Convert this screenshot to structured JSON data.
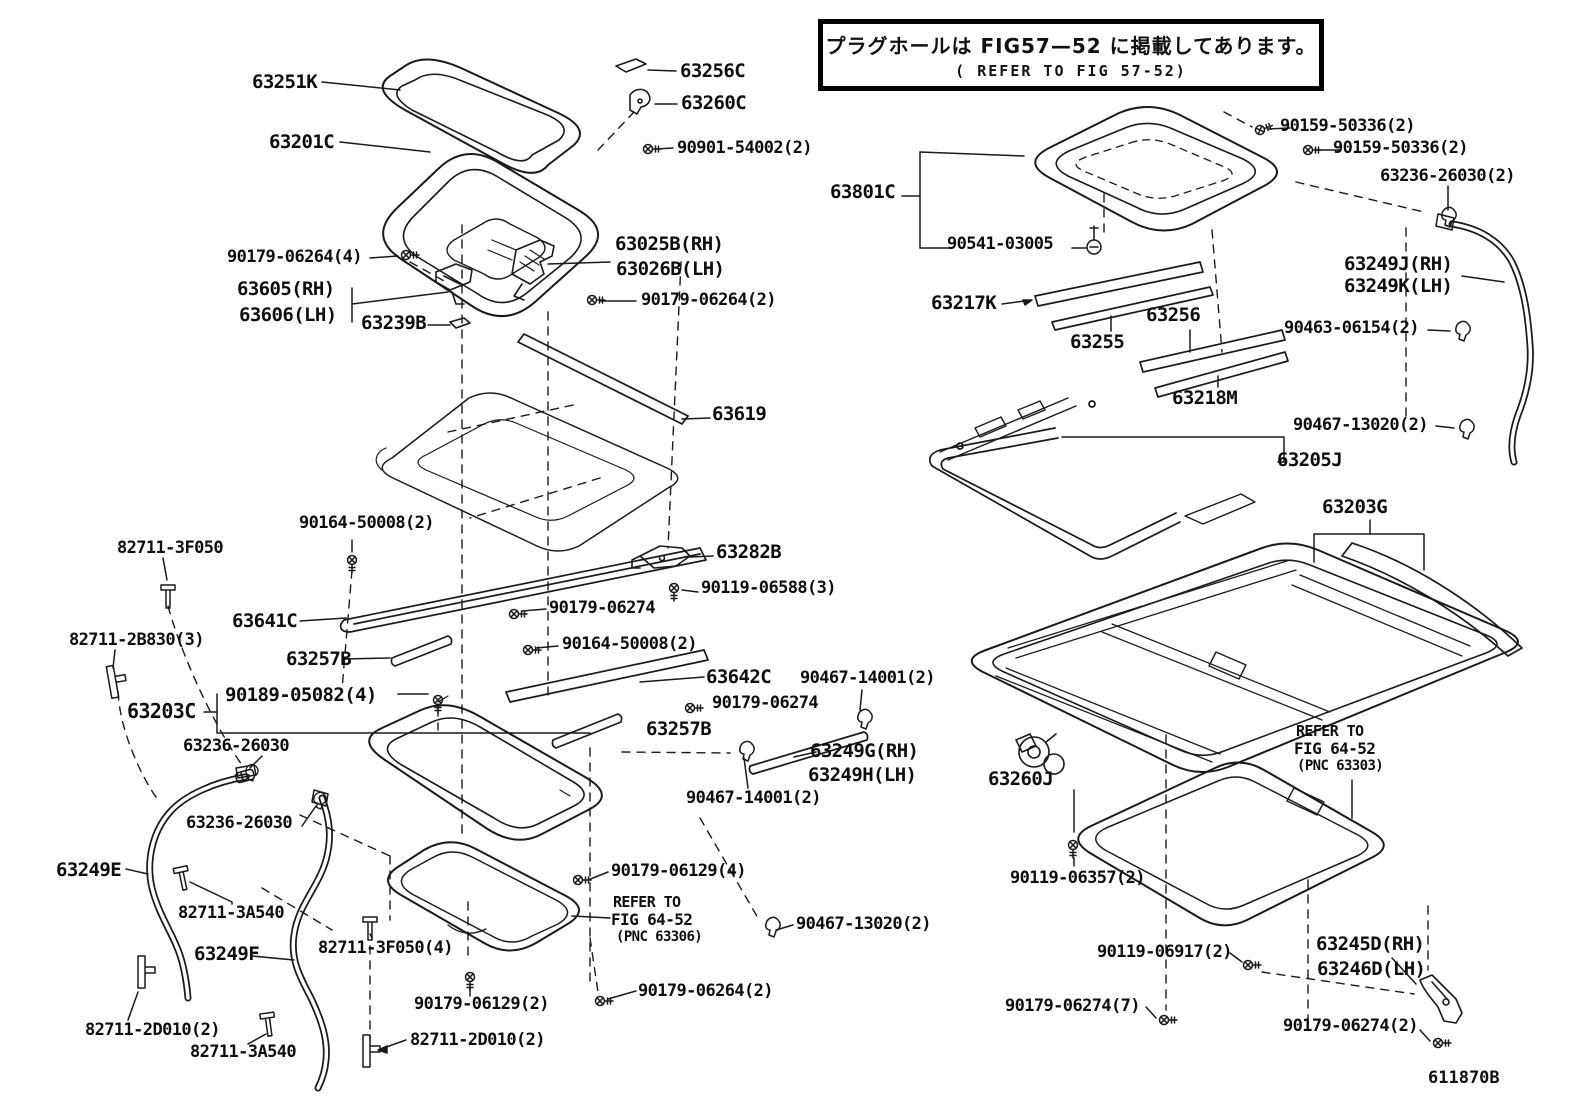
{
  "note_box": {
    "line1": "プラグホールは FIG57—52 に掲載してあります。",
    "line2": "( REFER TO FIG 57-52)"
  },
  "drawing_code": "611870B",
  "labels": [
    {
      "id": "63251k",
      "text": "63251K",
      "x": 252,
      "y": 73,
      "s": 19
    },
    {
      "id": "63201c",
      "text": "63201C",
      "x": 269,
      "y": 133,
      "s": 19
    },
    {
      "id": "63256c",
      "text": "63256C",
      "x": 680,
      "y": 62,
      "s": 19
    },
    {
      "id": "63260c",
      "text": "63260C",
      "x": 681,
      "y": 94,
      "s": 19
    },
    {
      "id": "90901-54002",
      "text": "90901-54002(2)",
      "x": 677,
      "y": 140,
      "s": 17
    },
    {
      "id": "90179-06264-4",
      "text": "90179-06264(4)",
      "x": 227,
      "y": 249,
      "s": 17
    },
    {
      "id": "63605-rh",
      "text": "63605(RH)",
      "x": 237,
      "y": 280,
      "s": 19
    },
    {
      "id": "63606-lh",
      "text": "63606(LH)",
      "x": 239,
      "y": 306,
      "s": 19
    },
    {
      "id": "63239b",
      "text": "63239B",
      "x": 361,
      "y": 314,
      "s": 19
    },
    {
      "id": "63025b-rh",
      "text": "63025B(RH)",
      "x": 615,
      "y": 235,
      "s": 19
    },
    {
      "id": "63026b-lh",
      "text": "63026B(LH)",
      "x": 616,
      "y": 260,
      "s": 19
    },
    {
      "id": "90179-06264-2a",
      "text": "90179-06264(2)",
      "x": 641,
      "y": 292,
      "s": 17
    },
    {
      "id": "63619",
      "text": "63619",
      "x": 712,
      "y": 405,
      "s": 19
    },
    {
      "id": "90164-50008-a",
      "text": "90164-50008(2)",
      "x": 299,
      "y": 515,
      "s": 17
    },
    {
      "id": "82711-3f050-a",
      "text": "82711-3F050",
      "x": 117,
      "y": 540,
      "s": 17
    },
    {
      "id": "63282b",
      "text": "63282B",
      "x": 716,
      "y": 543,
      "s": 19
    },
    {
      "id": "90119-06588",
      "text": "90119-06588(3)",
      "x": 701,
      "y": 580,
      "s": 17
    },
    {
      "id": "90179-06274-a",
      "text": "90179-06274",
      "x": 549,
      "y": 600,
      "s": 17
    },
    {
      "id": "63641c",
      "text": "63641C",
      "x": 232,
      "y": 612,
      "s": 19
    },
    {
      "id": "82711-2b830",
      "text": "82711-2B830(3)",
      "x": 69,
      "y": 632,
      "s": 17
    },
    {
      "id": "90164-50008-b",
      "text": "90164-50008(2)",
      "x": 562,
      "y": 636,
      "s": 17
    },
    {
      "id": "63257b-a",
      "text": "63257B",
      "x": 286,
      "y": 650,
      "s": 19
    },
    {
      "id": "63642c",
      "text": "63642C",
      "x": 706,
      "y": 668,
      "s": 19
    },
    {
      "id": "90467-14001-a",
      "text": "90467-14001(2)",
      "x": 800,
      "y": 670,
      "s": 17
    },
    {
      "id": "90189-05082",
      "text": "90189-05082(4)",
      "x": 225,
      "y": 686,
      "s": 19
    },
    {
      "id": "63203c",
      "text": "63203C",
      "x": 127,
      "y": 701,
      "s": 20
    },
    {
      "id": "90179-06274-b",
      "text": "90179-06274",
      "x": 712,
      "y": 695,
      "s": 17
    },
    {
      "id": "63257b-b",
      "text": "63257B",
      "x": 646,
      "y": 720,
      "s": 19
    },
    {
      "id": "63236-26030-a",
      "text": "63236-26030",
      "x": 183,
      "y": 738,
      "s": 17
    },
    {
      "id": "63249g-rh",
      "text": "63249G(RH)",
      "x": 810,
      "y": 742,
      "s": 19
    },
    {
      "id": "63249h-lh",
      "text": "63249H(LH)",
      "x": 808,
      "y": 766,
      "s": 19
    },
    {
      "id": "90467-14001-b",
      "text": "90467-14001(2)",
      "x": 686,
      "y": 790,
      "s": 17
    },
    {
      "id": "63236-26030-b",
      "text": "63236-26030",
      "x": 186,
      "y": 815,
      "s": 17
    },
    {
      "id": "63249e",
      "text": "63249E",
      "x": 56,
      "y": 861,
      "s": 19
    },
    {
      "id": "82711-3a540-a",
      "text": "82711-3A540",
      "x": 178,
      "y": 905,
      "s": 17
    },
    {
      "id": "63249f",
      "text": "63249F",
      "x": 194,
      "y": 945,
      "s": 19
    },
    {
      "id": "82711-3f050-b",
      "text": "82711-3F050(4)",
      "x": 318,
      "y": 940,
      "s": 17
    },
    {
      "id": "90179-06129-4",
      "text": "90179-06129(4)",
      "x": 611,
      "y": 863,
      "s": 17
    },
    {
      "id": "refer-306-1",
      "text": "REFER TO",
      "x": 613,
      "y": 895,
      "s": 15
    },
    {
      "id": "refer-306-2",
      "text": "FIG 64-52",
      "x": 611,
      "y": 912,
      "s": 16
    },
    {
      "id": "refer-306-3",
      "text": "(PNC 63306)",
      "x": 616,
      "y": 930,
      "s": 14
    },
    {
      "id": "90467-13020-l",
      "text": "90467-13020(2)",
      "x": 796,
      "y": 916,
      "s": 17
    },
    {
      "id": "90179-06264-2b",
      "text": "90179-06264(2)",
      "x": 638,
      "y": 983,
      "s": 17
    },
    {
      "id": "90179-06129-2",
      "text": "90179-06129(2)",
      "x": 414,
      "y": 996,
      "s": 17
    },
    {
      "id": "82711-2d010-a",
      "text": "82711-2D010(2)",
      "x": 85,
      "y": 1022,
      "s": 17
    },
    {
      "id": "82711-2d010-b",
      "text": "82711-2D010(2)",
      "x": 410,
      "y": 1032,
      "s": 17
    },
    {
      "id": "82711-3a540-b",
      "text": "82711-3A540",
      "x": 190,
      "y": 1044,
      "s": 17
    },
    {
      "id": "63801c",
      "text": "63801C",
      "x": 830,
      "y": 183,
      "s": 19
    },
    {
      "id": "90159-50336-a",
      "text": "90159-50336(2)",
      "x": 1280,
      "y": 118,
      "s": 17
    },
    {
      "id": "90159-50336-b",
      "text": "90159-50336(2)",
      "x": 1333,
      "y": 140,
      "s": 17
    },
    {
      "id": "63236-26030-2",
      "text": "63236-26030(2)",
      "x": 1380,
      "y": 168,
      "s": 17
    },
    {
      "id": "90541-03005",
      "text": "90541-03005",
      "x": 947,
      "y": 236,
      "s": 17
    },
    {
      "id": "63217k",
      "text": "63217K",
      "x": 931,
      "y": 294,
      "s": 19
    },
    {
      "id": "63255",
      "text": "63255",
      "x": 1070,
      "y": 333,
      "s": 19
    },
    {
      "id": "63256",
      "text": "63256",
      "x": 1146,
      "y": 306,
      "s": 19
    },
    {
      "id": "63218m",
      "text": "63218M",
      "x": 1172,
      "y": 389,
      "s": 19
    },
    {
      "id": "63205j",
      "text": "63205J",
      "x": 1277,
      "y": 451,
      "s": 19
    },
    {
      "id": "90463-06154",
      "text": "90463-06154(2)",
      "x": 1284,
      "y": 320,
      "s": 17
    },
    {
      "id": "90467-13020-r",
      "text": "90467-13020(2)",
      "x": 1293,
      "y": 417,
      "s": 17
    },
    {
      "id": "63249j-rh",
      "text": "63249J(RH)",
      "x": 1344,
      "y": 255,
      "s": 19
    },
    {
      "id": "63249k-lh",
      "text": "63249K(LH)",
      "x": 1344,
      "y": 277,
      "s": 19
    },
    {
      "id": "63203g",
      "text": "63203G",
      "x": 1322,
      "y": 498,
      "s": 19
    },
    {
      "id": "63260j",
      "text": "63260J",
      "x": 988,
      "y": 770,
      "s": 19
    },
    {
      "id": "90119-06357",
      "text": "90119-06357(2)",
      "x": 1010,
      "y": 870,
      "s": 17
    },
    {
      "id": "refer-303-1",
      "text": "REFER TO",
      "x": 1296,
      "y": 724,
      "s": 15
    },
    {
      "id": "refer-303-2",
      "text": "FIG 64-52",
      "x": 1294,
      "y": 741,
      "s": 16
    },
    {
      "id": "refer-303-3",
      "text": "(PNC 63303)",
      "x": 1297,
      "y": 759,
      "s": 14
    },
    {
      "id": "90119-06917",
      "text": "90119-06917(2)",
      "x": 1097,
      "y": 944,
      "s": 17
    },
    {
      "id": "63245d-rh",
      "text": "63245D(RH)",
      "x": 1316,
      "y": 935,
      "s": 19
    },
    {
      "id": "63246d-lh",
      "text": "63246D(LH)",
      "x": 1317,
      "y": 960,
      "s": 19
    },
    {
      "id": "90179-06274-7",
      "text": "90179-06274(7)",
      "x": 1005,
      "y": 998,
      "s": 17
    },
    {
      "id": "90179-06274-2r",
      "text": "90179-06274(2)",
      "x": 1283,
      "y": 1018,
      "s": 17
    },
    {
      "id": "611870b-note",
      "text": "",
      "x": 0,
      "y": 0,
      "s": 1
    }
  ]
}
